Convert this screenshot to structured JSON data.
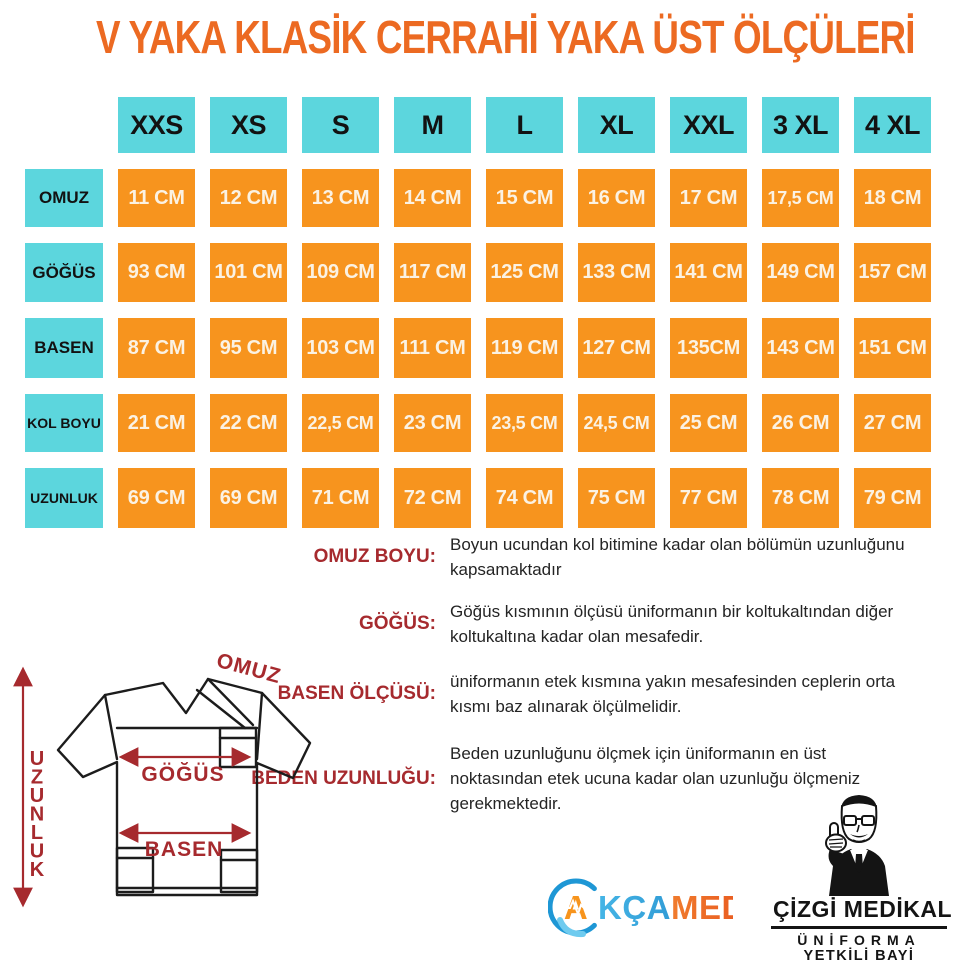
{
  "title": "V YAKA KLASİK CERRAHİ YAKA ÜST ÖLÇÜLERİ",
  "colors": {
    "title_orange": "#EC6A22",
    "cell_cyan": "#5CD6DD",
    "cell_orange": "#F7941E",
    "cell_text_cream": "#FBF2E3",
    "annotation_red": "#A62A2E",
    "line_black": "#1C1C1C"
  },
  "size_table": {
    "columns": [
      "XXS",
      "XS",
      "S",
      "M",
      "L",
      "XL",
      "XXL",
      "3 XL",
      "4 XL"
    ],
    "rows": [
      {
        "label": "OMUZ",
        "values": [
          "11 CM",
          "12 CM",
          "13 CM",
          "14 CM",
          "15 CM",
          "16 CM",
          "17 CM",
          "17,5 CM",
          "18 CM"
        ]
      },
      {
        "label": "GÖĞÜS",
        "values": [
          "93 CM",
          "101 CM",
          "109 CM",
          "117 CM",
          "125 CM",
          "133 CM",
          "141 CM",
          "149 CM",
          "157 CM"
        ]
      },
      {
        "label": "BASEN",
        "values": [
          "87 CM",
          "95 CM",
          "103 CM",
          "111 CM",
          "119 CM",
          "127 CM",
          "135CM",
          "143 CM",
          "151 CM"
        ]
      },
      {
        "label": "KOL BOYU",
        "values": [
          "21 CM",
          "22 CM",
          "22,5 CM",
          "23 CM",
          "23,5 CM",
          "24,5 CM",
          "25 CM",
          "26 CM",
          "27 CM"
        ]
      },
      {
        "label": "UZUNLUK",
        "values": [
          "69 CM",
          "69 CM",
          "71 CM",
          "72 CM",
          "74 CM",
          "75 CM",
          "77 CM",
          "78 CM",
          "79 CM"
        ]
      }
    ]
  },
  "definitions": [
    {
      "label": "OMUZ BOYU:",
      "text": "Boyun ucundan kol bitimine kadar olan bölümün uzunluğunu\nkapsamaktadır"
    },
    {
      "label": "GÖĞÜS:",
      "text": "Göğüs kısmının ölçüsü üniformanın bir koltukaltından diğer\nkoltukaltına kadar olan mesafedir."
    },
    {
      "label": "BASEN ÖLÇÜSÜ:",
      "text": "üniformanın etek kısmına yakın mesafesinden ceplerin orta\nkısmı baz alınarak ölçülmelidir."
    },
    {
      "label": "BEDEN UZUNLUĞU:",
      "text": "Beden uzunluğunu ölçmek için üniformanın en üst\nnoktasından etek ucuna kadar olan uzunluğu ölçmeniz\ngerekmektedir."
    }
  ],
  "diagram": {
    "labels": {
      "omuz": "OMUZ",
      "gogus": "GÖĞÜS",
      "basen": "BASEN",
      "uzunluk": "UZUNLUK"
    }
  },
  "logos": {
    "akcamed": {
      "letter_a": "A",
      "part_kca": "KÇA",
      "part_med": "MED"
    },
    "cizgi": {
      "line1": "ÇİZGİ MEDİKAL",
      "line2": "ÜNİFORMA",
      "line3": "YETKİLİ BAYİ"
    }
  }
}
